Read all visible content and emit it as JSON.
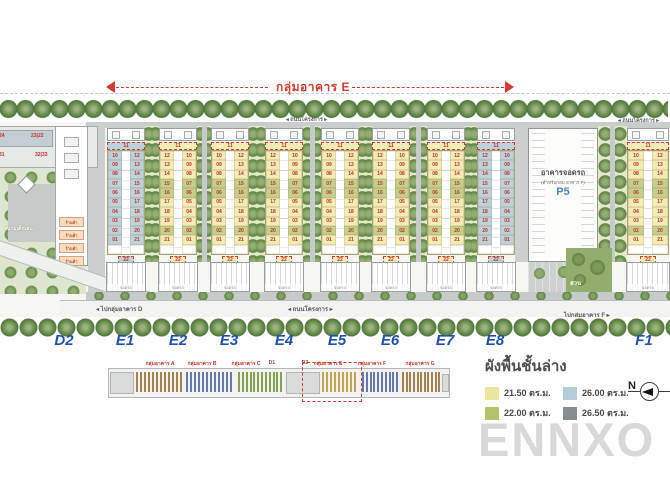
{
  "top": {
    "group_span_label": "กลุ่มอาคาร E",
    "road_label": "◂ ถนนโครงการ ▸",
    "road_label_right": "◂ ถนนโครงการ ▸"
  },
  "plan": {
    "d2_building": {
      "row1": [
        "24",
        "23|22",
        "21|20"
      ],
      "row2": [
        "31",
        "32|33",
        "34"
      ]
    },
    "playground_label": "สนามเด็กเล่น",
    "shops": [
      "ร้านค้า",
      "ร้านค้า",
      "ร้านค้า",
      "ร้านค้า"
    ],
    "unit_columns": {
      "header": "11",
      "left": [
        "10",
        "09",
        "08",
        "07",
        "06",
        "05",
        "04",
        "03",
        "02",
        "01"
      ],
      "right": [
        "12",
        "13",
        "14",
        "15",
        "16",
        "17",
        "18",
        "19",
        "20",
        "21"
      ],
      "footer": "22"
    },
    "strips": [
      {
        "id": "E1",
        "x": 107,
        "palette": "blue",
        "mirror": false
      },
      {
        "id": "E2",
        "x": 159,
        "palette": "yellow",
        "mirror": true
      },
      {
        "id": "E3",
        "x": 211,
        "palette": "yellow",
        "mirror": false
      },
      {
        "id": "E4",
        "x": 265,
        "palette": "yellow",
        "mirror": true
      },
      {
        "id": "E5",
        "x": 321,
        "palette": "yellow",
        "mirror": false
      },
      {
        "id": "E6",
        "x": 372,
        "palette": "yellow",
        "mirror": true
      },
      {
        "id": "E7",
        "x": 427,
        "palette": "yellow",
        "mirror": false
      },
      {
        "id": "E8",
        "x": 477,
        "palette": "blue",
        "mirror": true
      },
      {
        "id": "F1",
        "x": 627,
        "palette": "yellow",
        "mirror": false
      }
    ],
    "garage_label": "จอดรถ",
    "parking_building": {
      "title": "อาคารจอดรถ",
      "subtitle": "(สำหรับกลุ่ม อาคาร F)",
      "code": "P5"
    },
    "park_label": "สวน",
    "roads": {
      "to_d": "◂ ไปกลุ่มอาคาร D",
      "project": "◂ ถนนโครงการ ▸",
      "to_f": "ไปกลุ่มอาคาร F ▸"
    }
  },
  "markers": [
    {
      "label": "D2",
      "x": 64
    },
    {
      "label": "E1",
      "x": 125
    },
    {
      "label": "E2",
      "x": 178
    },
    {
      "label": "E3",
      "x": 229
    },
    {
      "label": "E4",
      "x": 284
    },
    {
      "label": "E5",
      "x": 337
    },
    {
      "label": "E6",
      "x": 390
    },
    {
      "label": "E7",
      "x": 445
    },
    {
      "label": "E8",
      "x": 495
    },
    {
      "label": "F1",
      "x": 644
    }
  ],
  "minimap": {
    "sections": [
      {
        "label": "กลุ่มอาคาร A",
        "color": "#a5814f"
      },
      {
        "label": "กลุ่มอาคาร B",
        "color": "#6677ab"
      },
      {
        "label": "กลุ่มอาคาร C",
        "color": "#85a254"
      },
      {
        "label": "D1",
        "color": "#c9ccca"
      },
      {
        "label": "D2",
        "color": "#c9ccca"
      },
      {
        "label": "กลุ่มอาคาร E",
        "color": "#c3a254",
        "highlight": true
      },
      {
        "label": "กลุ่มอาคาร F",
        "color": "#6677ab"
      },
      {
        "label": "กลุ่มอาคาร G",
        "color": "#a5814f"
      }
    ]
  },
  "legend": {
    "title": "ผังพื้นชั้นล่าง",
    "items": [
      {
        "label": "21.50 ตร.ม.",
        "color": "#e9e6a0"
      },
      {
        "label": "26.00 ตร.ม.",
        "color": "#b5cdd6"
      },
      {
        "label": "22.00 ตร.ม.",
        "color": "#b3c26b"
      },
      {
        "label": "26.50 ตร.ม.",
        "color": "#868e92"
      }
    ],
    "north": "N"
  },
  "watermark": "ENNXO",
  "colors": {
    "accent_red": "#d23b30",
    "label_blue": "#1d52a8",
    "unit_yellow": "#f1edb4",
    "unit_green": "#c3d08b",
    "unit_blue": "#bdd3db",
    "p5_blue": "#4a86c8"
  }
}
